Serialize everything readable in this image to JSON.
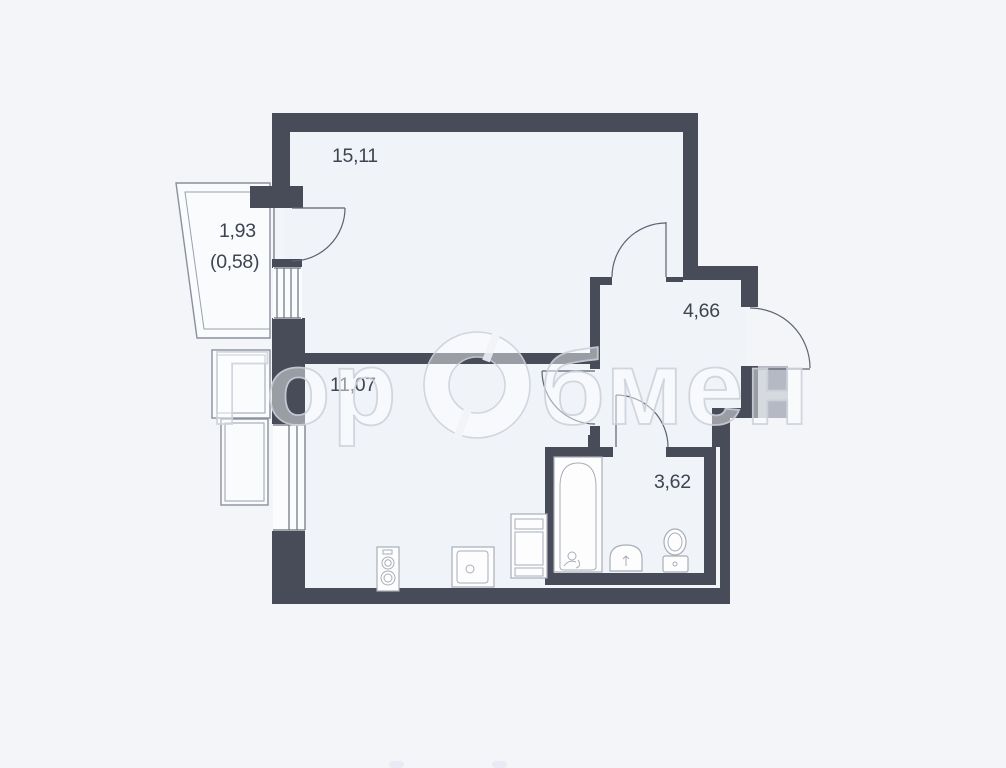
{
  "page": {
    "background": "#f3f5f9"
  },
  "plan": {
    "type": "apartment-floor-plan",
    "colors": {
      "wall": "#474c58",
      "adjacent_wall": "#b4b9c3",
      "interior": "#f0f3f8",
      "door_line": "#5d6370",
      "fixture_line": "#a8aeb9",
      "label_text": "#3e4451",
      "watermark_stroke": "#ced3dc"
    },
    "rooms": [
      {
        "name": "living-room",
        "area": "15,11"
      },
      {
        "name": "balcony",
        "area": "1,93",
        "area_reduced": "(0,58)"
      },
      {
        "name": "kitchen",
        "area": "11,07"
      },
      {
        "name": "hallway",
        "area": "4,66"
      },
      {
        "name": "bathroom",
        "area": "3,62"
      }
    ],
    "watermark": {
      "prefix": "Гор",
      "suffix": "бмен"
    }
  }
}
